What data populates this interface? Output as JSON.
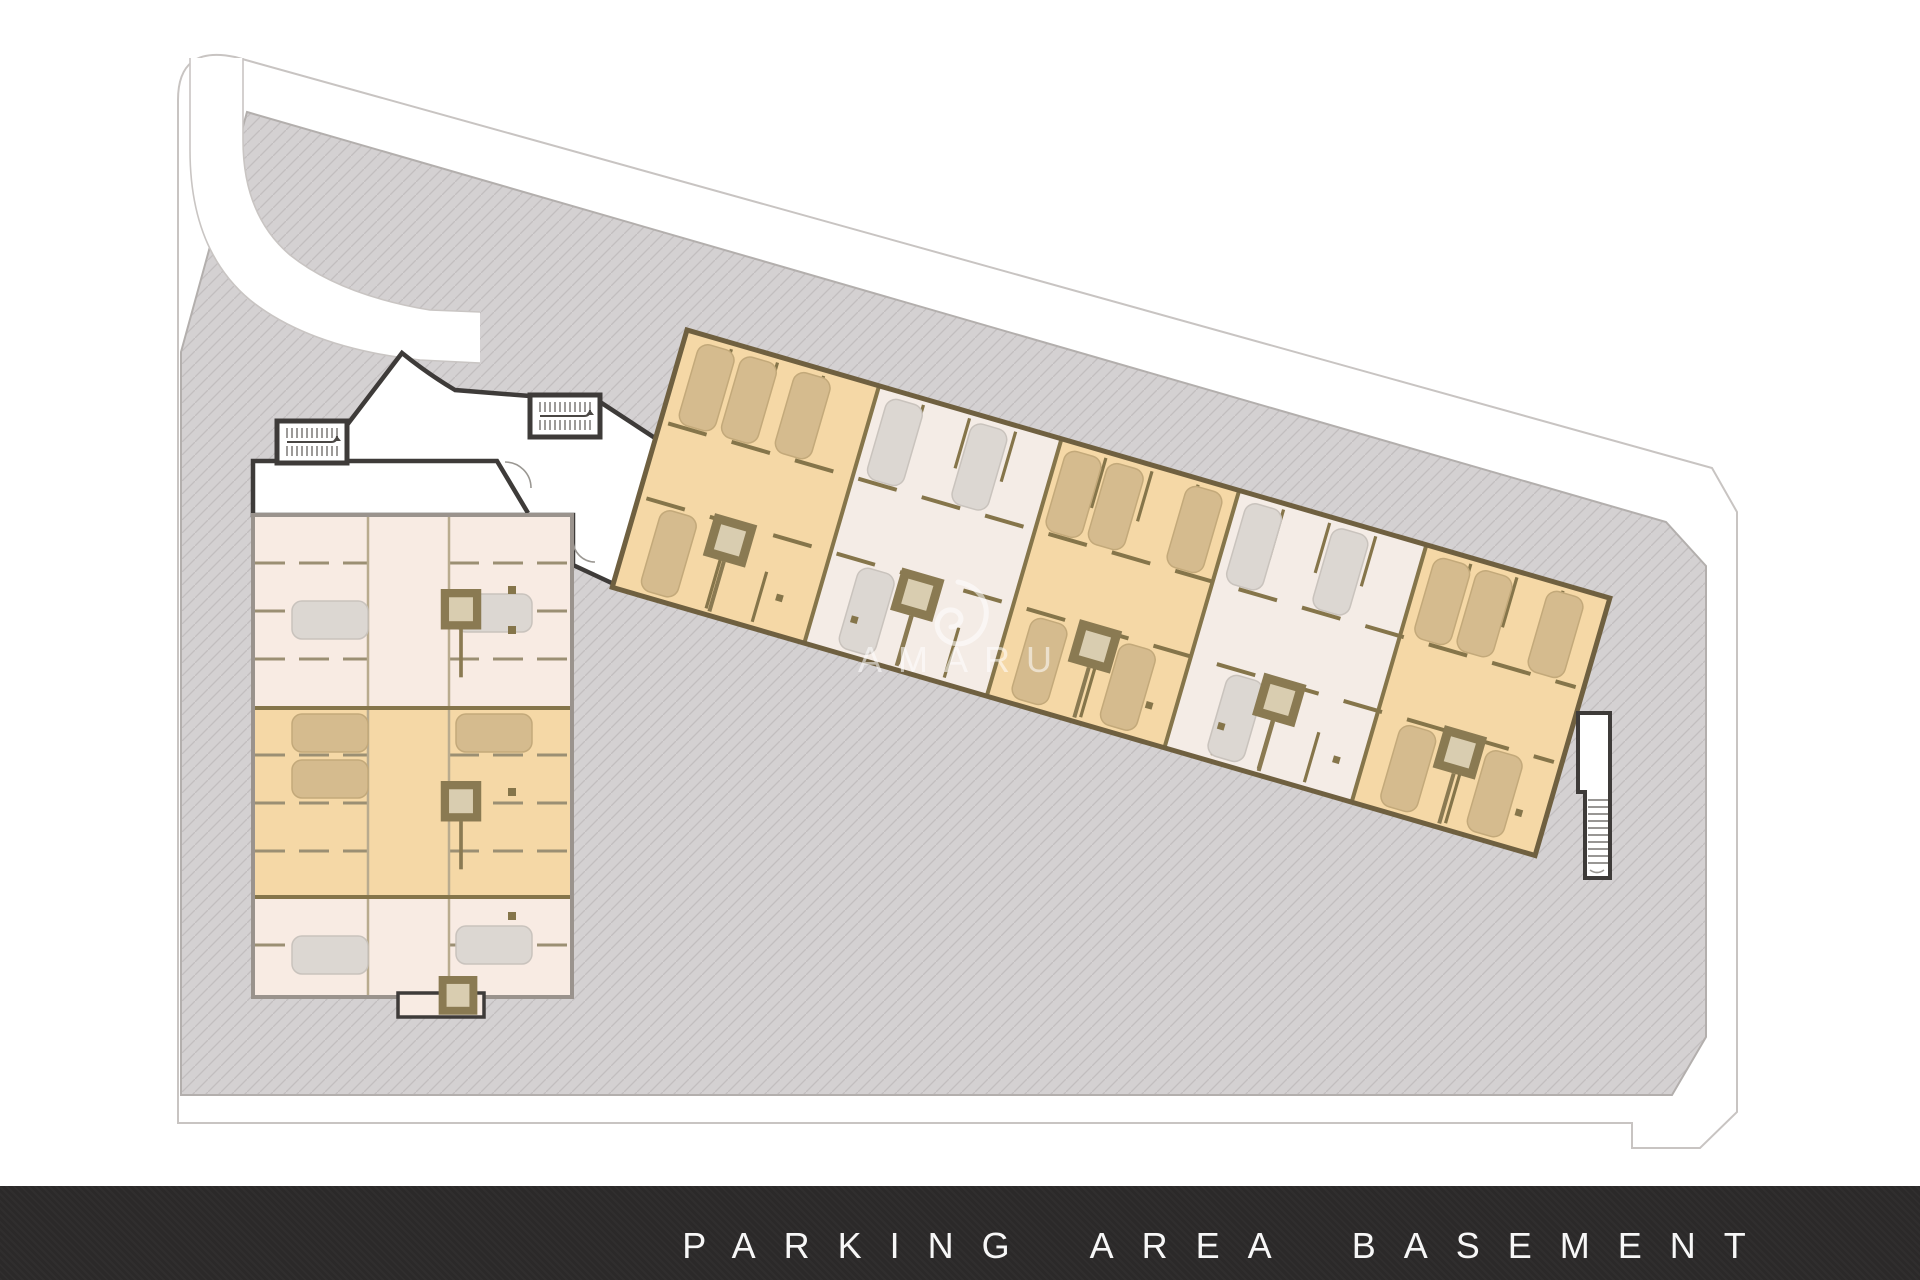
{
  "footer": {
    "label": "PARKING AREA BASEMENT"
  },
  "watermark": {
    "text": "AMARU",
    "logo_icon": "chameleon-curl-icon"
  },
  "plan": {
    "left_block_bands": [
      "pink",
      "orange",
      "pink"
    ],
    "right_block_bands": [
      "orange",
      "cream",
      "orange",
      "cream",
      "orange"
    ],
    "stairwells": 3,
    "elevator_cores": 8
  },
  "colors": {
    "site_gray": "#d4d1d2",
    "hatch_line": "#c2bebf",
    "site_edge": "#b3afad",
    "boundary_line": "#c8c4c2",
    "road_line": "#c9c5c3",
    "orange_unit": "#f5d8a6",
    "cream_unit": "#f4ece6",
    "pink_unit": "#f8ebe3",
    "wall_brown": "#85754a",
    "stall_line": "#9b8f73",
    "wall_dark": "#3e3b39",
    "wall_gray": "#9a938d",
    "car_tan": "#d5bb8e",
    "car_tan_stroke": "#c3a97a",
    "car_gray": "#dcd7d2",
    "car_gray_stroke": "#c9c3bd",
    "core_brown": "#8a7a52",
    "core_fill": "#d9cdb0",
    "watermark": "rgba(255,255,255,0.55)",
    "footer_bg": "#2b2929",
    "footer_text": "#f7f7f7"
  }
}
